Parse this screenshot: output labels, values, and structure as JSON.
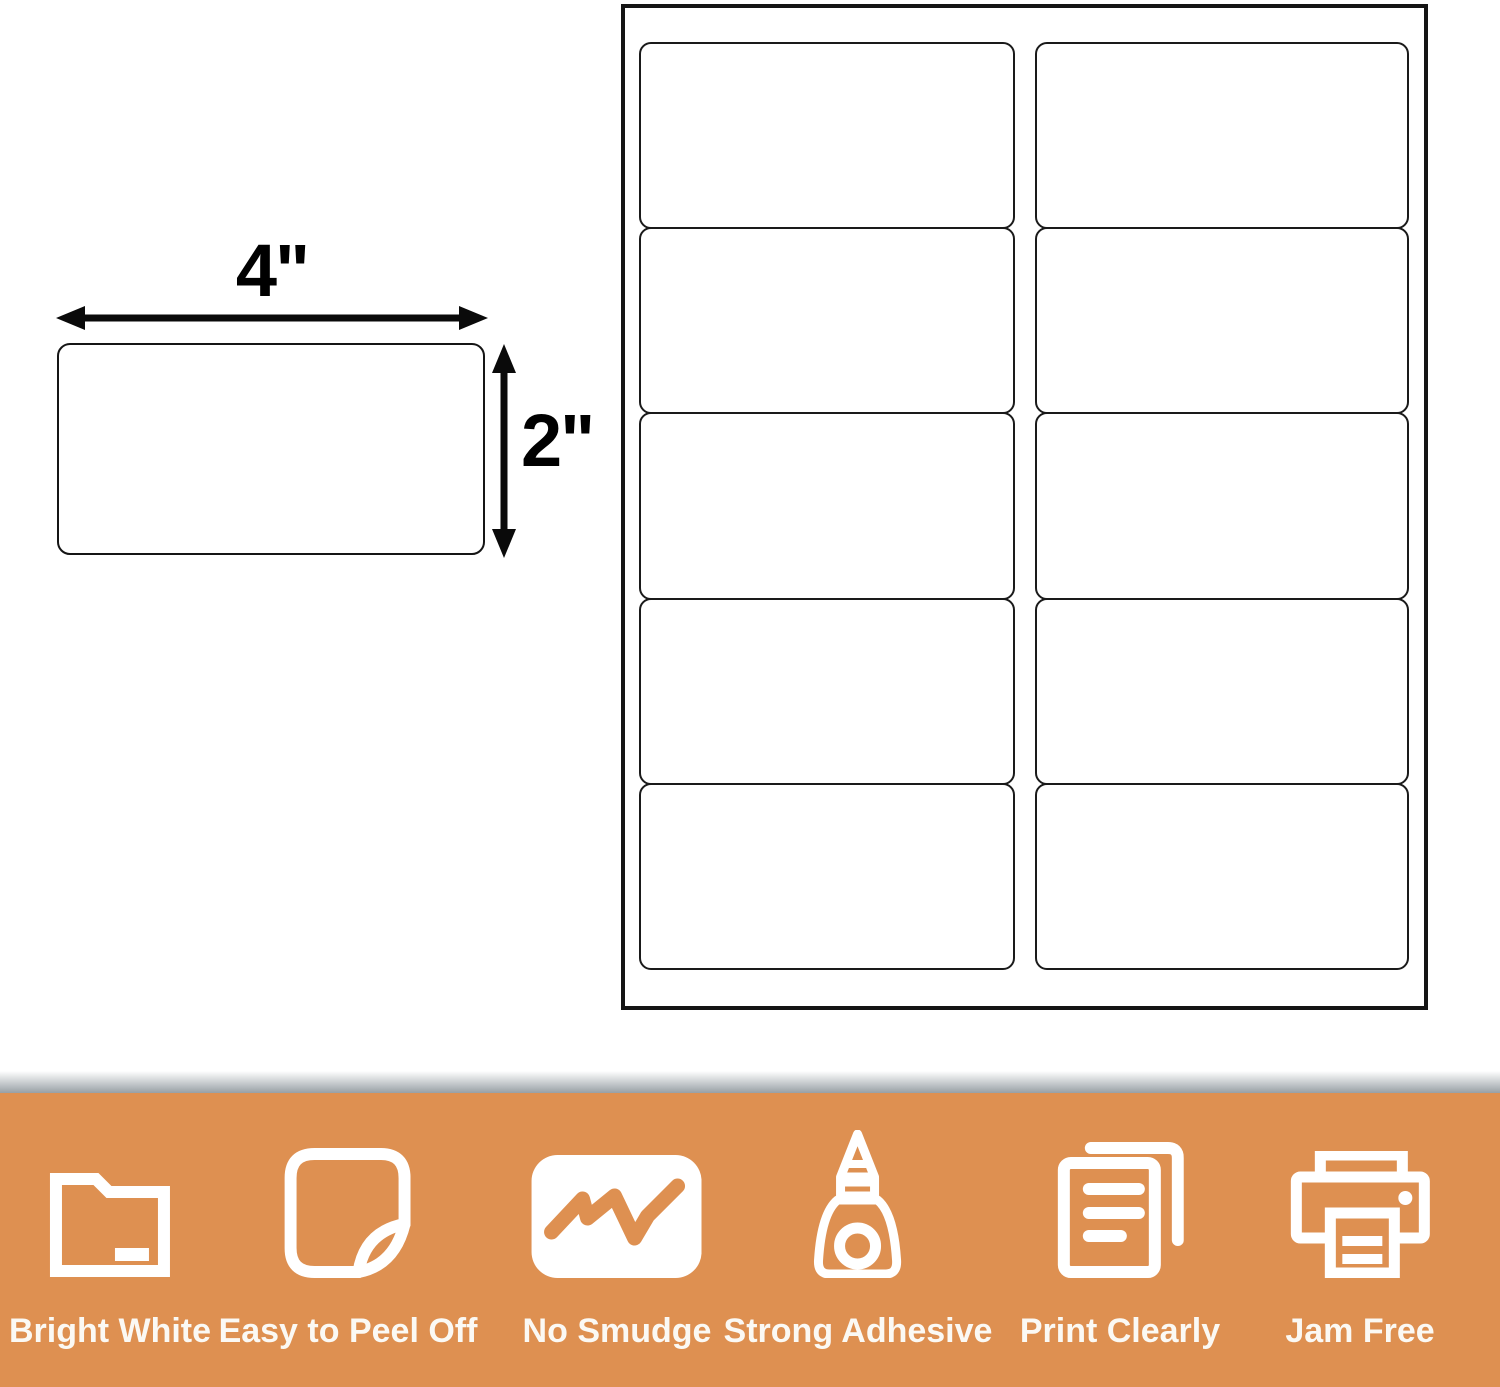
{
  "diagram": {
    "width_label": "4\"",
    "height_label": "2\""
  },
  "sheet": {
    "rows": 5,
    "columns": 2,
    "label_count": 10
  },
  "banner": {
    "background_color": "#DE9051",
    "text_color": "#FBF9F4",
    "features": [
      {
        "icon": "folder-icon",
        "label": "Bright White"
      },
      {
        "icon": "peel-sticker-icon",
        "label": "Easy to Peel Off"
      },
      {
        "icon": "no-smudge-icon",
        "label": "No Smudge"
      },
      {
        "icon": "glue-bottle-icon",
        "label": "Strong Adhesive"
      },
      {
        "icon": "documents-icon",
        "label": "Print Clearly"
      },
      {
        "icon": "printer-icon",
        "label": "Jam Free"
      }
    ]
  },
  "colors": {
    "line": "#151515",
    "gradient_top": "#FFFFFF",
    "gradient_bottom": "#98A0A5"
  }
}
